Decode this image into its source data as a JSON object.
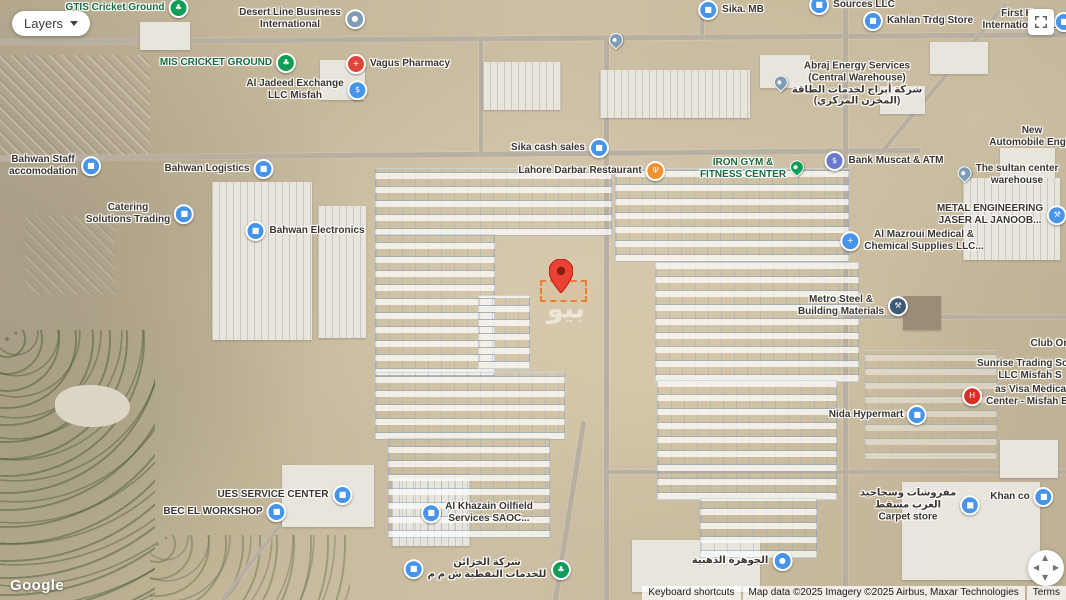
{
  "controls": {
    "layers_label": "Layers",
    "fullscreen_icon": "fullscreen-icon",
    "pan_icon": "pan-control"
  },
  "logo": "Google",
  "watermark": "بيو",
  "marker": {
    "color": "#EA4335",
    "inner": "#8C1A11",
    "plot_outline": "#ED7D31"
  },
  "attribution": {
    "keyboard_shortcuts": "Keyboard shortcuts",
    "map_data": "Map data ©2025  Imagery ©2025 Airbus, Maxar Technologies",
    "terms": "Terms"
  },
  "colors": {
    "poi_blue": "#4694EC",
    "poi_green": "#0F9D58",
    "poi_gray": "#7E9CB5",
    "poi_red": "#E0453A",
    "poi_orange": "#F09231",
    "poi_indigo": "#6A78CE",
    "poi_navy": "#3D5A73",
    "hospital_red": "#D93025"
  },
  "places": [
    {
      "id": "place-gtis-cricket-ground",
      "lines": [
        "GTIS Cricket Ground"
      ],
      "style": "green",
      "icon": "tree-icon",
      "shape": "circle",
      "color": "#0F9D58",
      "glyph": "♣",
      "side": "right",
      "x": 127,
      "y": 8
    },
    {
      "id": "place-desert-line-business",
      "lines": [
        "Desert Line Business",
        "International"
      ],
      "style": "dark",
      "icon": "generic-place-icon",
      "shape": "circle",
      "color": "#7E9CB5",
      "glyph": "●",
      "side": "right",
      "x": 302,
      "y": 19
    },
    {
      "id": "place-mis-cricket-ground",
      "lines": [
        "MIS CRICKET GROUND"
      ],
      "style": "green",
      "icon": "tree-icon",
      "shape": "circle",
      "color": "#0F9D58",
      "glyph": "♣",
      "side": "right",
      "x": 228,
      "y": 63
    },
    {
      "id": "place-vagus-pharmacy",
      "lines": [
        "Vagus Pharmacy"
      ],
      "style": "dark",
      "icon": "pharmacy-icon",
      "shape": "circle",
      "color": "#E0453A",
      "glyph": "+",
      "side": "left",
      "x": 398,
      "y": 64
    },
    {
      "id": "place-al-jadeed-exchange",
      "lines": [
        "Al Jadeed Exchange",
        "LLC Misfah"
      ],
      "style": "dark",
      "icon": "currency-exchange-icon",
      "shape": "circle",
      "color": "#4694EC",
      "glyph": "$",
      "side": "right",
      "x": 307,
      "y": 90
    },
    {
      "id": "place-sika-mb",
      "lines": [
        "Sika. MB"
      ],
      "style": "dark",
      "icon": "store-icon",
      "shape": "circle",
      "color": "#4694EC",
      "glyph": "■",
      "side": "left",
      "x": 731,
      "y": 10
    },
    {
      "id": "place-sources-llc",
      "lines": [
        "Sources LLC"
      ],
      "style": "dark",
      "icon": "business-icon",
      "shape": "circle",
      "color": "#4694EC",
      "glyph": "■",
      "side": "left",
      "x": 852,
      "y": 5
    },
    {
      "id": "place-kahlan-trdg-store",
      "lines": [
        "Kahlan Trdg Store"
      ],
      "style": "dark",
      "icon": "shopping-bag-icon",
      "shape": "circle",
      "color": "#4694EC",
      "glyph": "■",
      "side": "left",
      "x": 918,
      "y": 21
    },
    {
      "id": "place-first-house-international",
      "lines": [
        "First Ho",
        "International Sc"
      ],
      "style": "dark",
      "x": 1020,
      "y": 20
    },
    {
      "id": "place-school-poi",
      "lines": [],
      "style": "dark",
      "icon": "school-icon",
      "shape": "circle",
      "color": "#4694EC",
      "glyph": "■",
      "side": "right",
      "x": 1064,
      "y": 22
    },
    {
      "id": "place-abraj-energy",
      "lines": [
        "Abraj Energy Services",
        "(Central Warehouse)",
        "شركة أبراج لخدمات الطاقة",
        "(المخزن المركزي)"
      ],
      "style": "dark",
      "icon": "place-pin-icon",
      "shape": "pin",
      "color": "#7E9CB5",
      "side": "left",
      "x": 848,
      "y": 84
    },
    {
      "id": "place-new-automobile",
      "lines": [
        "New",
        "Automobile Engin"
      ],
      "style": "dark",
      "x": 1032,
      "y": 137
    },
    {
      "id": "place-bahwan-staff",
      "lines": [
        "Bahwan Staff",
        "accomodation"
      ],
      "style": "dark",
      "icon": "business-icon",
      "shape": "circle",
      "color": "#4694EC",
      "glyph": "■",
      "side": "right",
      "x": 55,
      "y": 166
    },
    {
      "id": "place-bahwan-logistics",
      "lines": [
        "Bahwan Logistics"
      ],
      "style": "dark",
      "icon": "business-icon",
      "shape": "circle",
      "color": "#4694EC",
      "glyph": "■",
      "side": "right",
      "x": 219,
      "y": 169
    },
    {
      "id": "place-catering-solutions",
      "lines": [
        "Catering",
        "Solutions Trading"
      ],
      "style": "dark",
      "icon": "business-icon",
      "shape": "circle",
      "color": "#4694EC",
      "glyph": "■",
      "side": "right",
      "x": 140,
      "y": 214
    },
    {
      "id": "place-bahwan-electronics",
      "lines": [
        "Bahwan Electronics"
      ],
      "style": "dark",
      "icon": "business-icon",
      "shape": "circle",
      "color": "#4694EC",
      "glyph": "■",
      "side": "left",
      "x": 305,
      "y": 231
    },
    {
      "id": "place-sika-cash-sales",
      "lines": [
        "Sika cash sales"
      ],
      "style": "dark",
      "icon": "shopping-bag-icon",
      "shape": "circle",
      "color": "#4694EC",
      "glyph": "■",
      "side": "right",
      "x": 560,
      "y": 148
    },
    {
      "id": "place-lahore-darbar",
      "lines": [
        "Lahore Darbar Restaurant"
      ],
      "style": "dark",
      "icon": "restaurant-icon",
      "shape": "circle",
      "color": "#F09231",
      "glyph": "Ψ",
      "side": "right",
      "x": 592,
      "y": 171
    },
    {
      "id": "place-iron-gym",
      "lines": [
        "IRON GYM &",
        "FITNESS CENTER"
      ],
      "style": "green",
      "icon": "gym-pin-icon",
      "shape": "pin",
      "color": "#0F9D58",
      "side": "right",
      "x": 752,
      "y": 169
    },
    {
      "id": "place-bank-muscat",
      "lines": [
        "Bank Muscat & ATM"
      ],
      "style": "dark",
      "icon": "bank-icon",
      "shape": "circle",
      "color": "#6A78CE",
      "glyph": "$",
      "side": "left",
      "x": 884,
      "y": 161
    },
    {
      "id": "place-sultan-center",
      "lines": [
        "The sultan center",
        "warehouse"
      ],
      "style": "dark",
      "icon": "place-pin-icon",
      "shape": "pin",
      "color": "#7E9CB5",
      "side": "left",
      "x": 1008,
      "y": 175
    },
    {
      "id": "place-metal-engineering",
      "lines": [
        "METAL ENGINEERING",
        "JASER AL JANOOB..."
      ],
      "style": "dark",
      "icon": "factory-icon",
      "shape": "circle",
      "color": "#4694EC",
      "glyph": "⚒",
      "side": "right",
      "x": 1002,
      "y": 215
    },
    {
      "id": "place-al-mazroui-medical",
      "lines": [
        "Al Mazroui Medical &",
        "Chemical Supplies LLC..."
      ],
      "style": "dark",
      "icon": "medical-supplies-icon",
      "shape": "circle",
      "color": "#4694EC",
      "glyph": "+",
      "side": "left",
      "x": 912,
      "y": 241
    },
    {
      "id": "place-metro-steel",
      "lines": [
        "Metro Steel &",
        "Building Materials"
      ],
      "style": "dark",
      "icon": "hardware-icon",
      "shape": "circle",
      "color": "#3D5A73",
      "glyph": "⚒",
      "side": "right",
      "x": 853,
      "y": 306
    },
    {
      "id": "place-club-on",
      "lines": [
        "Club On"
      ],
      "style": "dark",
      "x": 1050,
      "y": 344
    },
    {
      "id": "place-sunrise-trading",
      "lines": [
        "Sunrise Trading Soluti",
        "LLC Misfah S"
      ],
      "style": "dark",
      "x": 1030,
      "y": 370
    },
    {
      "id": "place-visa-medical",
      "lines": [
        "as Visa Medical",
        "Center - Misfah Bra"
      ],
      "style": "dark",
      "icon": "hospital-icon",
      "shape": "circle",
      "color": "#D93025",
      "glyph": "H",
      "side": "left",
      "x": 1020,
      "y": 396
    },
    {
      "id": "place-nida-hypermart",
      "lines": [
        "Nida Hypermart"
      ],
      "style": "dark",
      "icon": "shopping-bag-icon",
      "shape": "circle",
      "color": "#4694EC",
      "glyph": "■",
      "side": "right",
      "x": 878,
      "y": 415
    },
    {
      "id": "place-ues-service-center",
      "lines": [
        "UES SERVICE CENTER"
      ],
      "style": "dark",
      "icon": "business-icon",
      "shape": "circle",
      "color": "#4694EC",
      "glyph": "■",
      "side": "right",
      "x": 285,
      "y": 495
    },
    {
      "id": "place-bec-el-workshop",
      "lines": [
        "BEC EL WORKSHOP"
      ],
      "style": "dark",
      "icon": "business-icon",
      "shape": "circle",
      "color": "#4694EC",
      "glyph": "■",
      "side": "right",
      "x": 225,
      "y": 512
    },
    {
      "id": "place-al-khazain-oilfield",
      "lines": [
        "Al Khazain Oilfield",
        "Services SAOC..."
      ],
      "style": "dark",
      "icon": "business-icon",
      "shape": "circle",
      "color": "#4694EC",
      "glyph": "■",
      "side": "left",
      "x": 477,
      "y": 513
    },
    {
      "id": "place-al-khazain-arabic",
      "lines": [
        "شركة الخزائن",
        "للخدمات النفطية ش م م"
      ],
      "style": "dark",
      "icon": "business-icon",
      "shape": "circle",
      "color": "#4694EC",
      "glyph": "■",
      "side": "left",
      "x": 475,
      "y": 569
    },
    {
      "id": "place-standalone-tree",
      "lines": [],
      "style": "green",
      "icon": "tree-icon",
      "shape": "circle",
      "color": "#0F9D58",
      "glyph": "♣",
      "side": "right",
      "x": 561,
      "y": 570
    },
    {
      "id": "place-al-jawhara",
      "lines": [
        "الجوهرة الذهبية"
      ],
      "style": "dark",
      "icon": "business-icon",
      "shape": "circle",
      "color": "#4694EC",
      "glyph": "●",
      "side": "right",
      "x": 742,
      "y": 561
    },
    {
      "id": "place-carpet-store",
      "lines": [
        "مفروشات وسجاجيد",
        "العرب مسقط",
        "Carpet store"
      ],
      "style": "dark",
      "icon": "shopping-bag-icon",
      "shape": "circle",
      "color": "#4694EC",
      "glyph": "■",
      "side": "right",
      "x": 920,
      "y": 505
    },
    {
      "id": "place-khan-co",
      "lines": [
        "Khan co"
      ],
      "style": "dark",
      "icon": "business-icon",
      "shape": "circle",
      "color": "#4694EC",
      "glyph": "■",
      "side": "right",
      "x": 1022,
      "y": 497
    },
    {
      "id": "place-unnamed-pin",
      "lines": [],
      "style": "dark",
      "icon": "place-pin-icon",
      "shape": "pin",
      "color": "#7E9CB5",
      "side": "right",
      "x": 616,
      "y": 42
    }
  ]
}
